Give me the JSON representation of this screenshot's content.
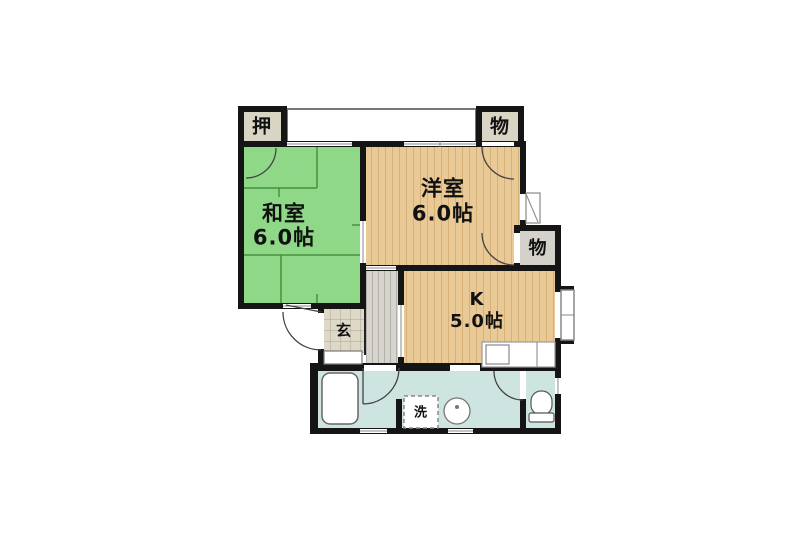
{
  "floorplan": {
    "labels": {
      "oshiire": "押",
      "storage_top": "物",
      "washitsu": "和室",
      "washitsu_size": "6.0帖",
      "youshitsu": "洋室",
      "youshitsu_size": "6.0帖",
      "storage_mid": "物",
      "kitchen": "K",
      "kitchen_size": "5.0帖",
      "genkan": "玄",
      "laundry": "洗"
    },
    "colors": {
      "tatami": "#8ed887",
      "tatami_line": "#46913f",
      "wood": "#e9c995",
      "wood_stripe": "#c49a5e",
      "closet": "#d9d5c5",
      "storage2": "#d3d1c9",
      "hallway": "#d6d4cc",
      "genkan_tile": "#ded9c7",
      "bath": "#cee4e1",
      "wall": "#151515",
      "background": "#ffffff"
    }
  }
}
